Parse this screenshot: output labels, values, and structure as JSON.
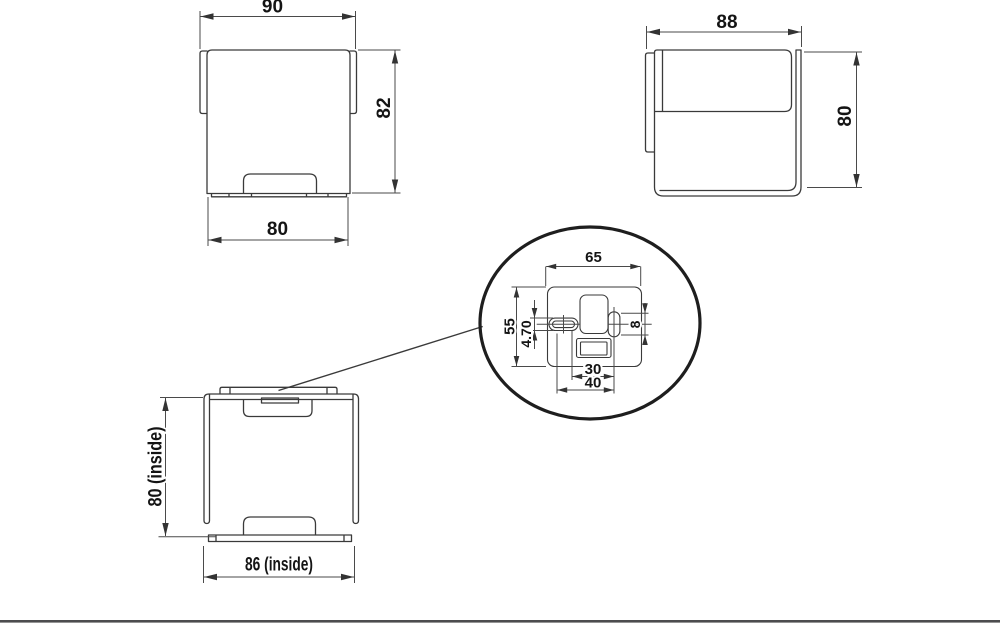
{
  "drawing": {
    "type": "technical-drawing",
    "views": {
      "front": {
        "label": "front view",
        "dims": {
          "top_width": "90",
          "height": "82",
          "bottom_width": "80"
        }
      },
      "side": {
        "label": "side view",
        "dims": {
          "width": "88",
          "height": "80"
        }
      },
      "top": {
        "label": "top view",
        "dims": {
          "inside_height": "80 (inside)",
          "inside_width": "86 (inside)"
        }
      },
      "detail": {
        "label": "mounting plate detail",
        "dims": {
          "plate_width": "65",
          "plate_height": "55",
          "slot_width": "4.70",
          "slot_length": "8",
          "hole_spacing_inner": "30",
          "hole_spacing_outer": "40"
        }
      }
    },
    "colors": {
      "line": "#3a3a3a",
      "dimension": "#4a4a4a",
      "text": "#141414",
      "detail_circle": "#1e1e1e",
      "footer_rule": "#4c4c4e",
      "background": "#ffffff"
    }
  }
}
